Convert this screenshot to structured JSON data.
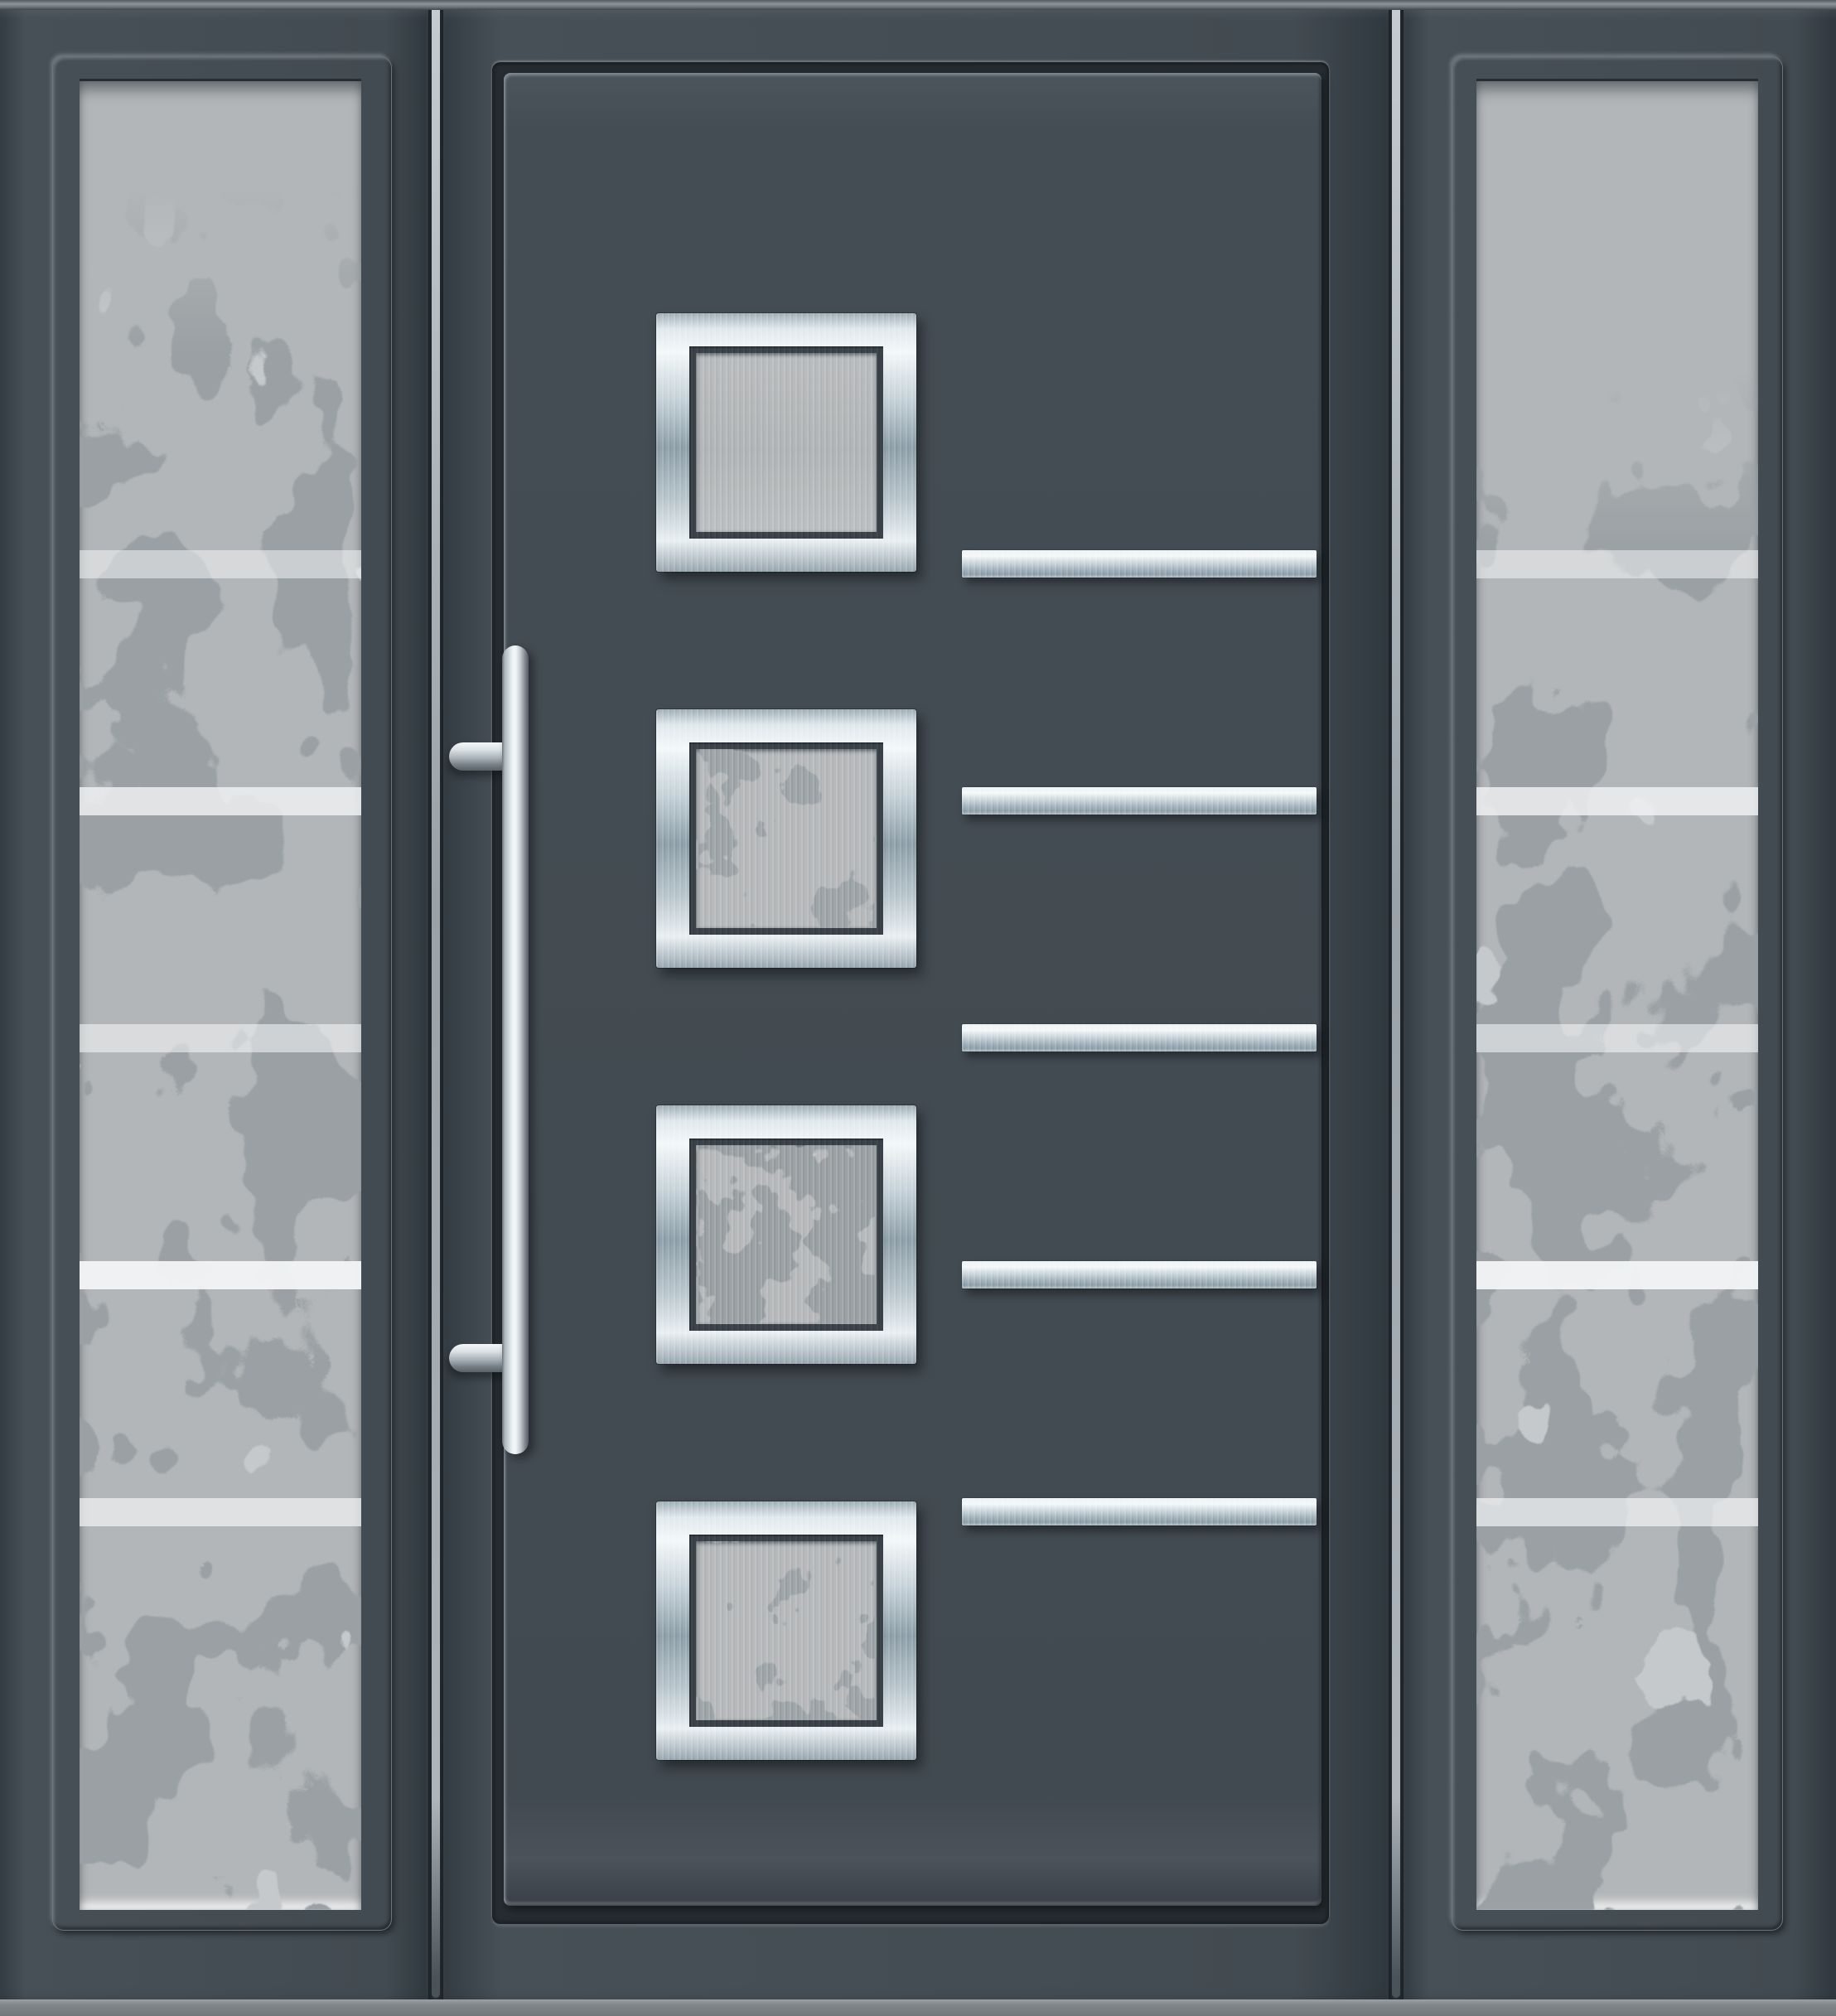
{
  "scene": {
    "type": "product-render",
    "subject": "Modern anthracite aluminium front entry door with two frosted glazed sidelights",
    "door": {
      "finish": "anthracite grey",
      "square_windows": {
        "count": 4,
        "frame": "brushed stainless steel",
        "glass": "frosted with tree silhouettes"
      },
      "steel_strips": {
        "count": 5,
        "finish": "brushed stainless steel"
      },
      "handle": {
        "type": "vertical pull bar",
        "standoffs": 2,
        "finish": "stainless steel"
      }
    },
    "sidelights": {
      "count": 2,
      "glass": "frosted with tree silhouettes",
      "white_stripes_per_panel": 5
    },
    "threshold": "light grey sill bar at bottom"
  },
  "colors": {
    "frame-dark": "#3f474e",
    "frame-face": "#434b52",
    "leaf-face": "#454d54",
    "gap-shadow": "#262c31",
    "mullion-highlight": "#c4ccd1",
    "edge-highlight": "#8d959b",
    "glass-base": "#b3b6b8",
    "glass-foliage": "#9aa0a3",
    "glass-foliage-light": "#c6c9cb",
    "glass-stripe": "#f2f4f5",
    "steel-light": "#f4f8f9",
    "steel-dark": "#8b9ca6",
    "bezel-dark": "#383f45",
    "sill": "#7f8589"
  }
}
